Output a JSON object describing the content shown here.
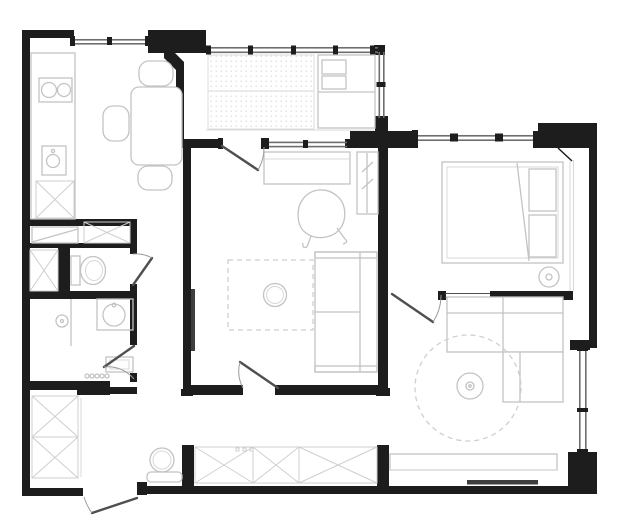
{
  "document": {
    "type": "apartment-floor-plan",
    "view": "top-down architectural drawing",
    "visible_text": "none"
  },
  "colors": {
    "background": "#ffffff",
    "wall": "#1d1d1d",
    "window": "#6e6e6e",
    "door_leaf": "#4f4f4f",
    "swing_arc": "#9a9a9a",
    "furniture": "#c3c3c3",
    "furniture_light": "#d8d8d8",
    "hatch": "#cfcfcf",
    "dark_accent": "#3f3f3f"
  },
  "rooms": [
    {
      "id": "kitchen-dining",
      "position": "top-left",
      "fixtures": [
        "kitchen-counter",
        "cooktop-two-burners",
        "kitchen-sink",
        "crosshatch-cabinet",
        "dining-table",
        "chair-top",
        "chair-left",
        "chair-bottom",
        "window-top"
      ]
    },
    {
      "id": "balcony",
      "position": "top-center",
      "fixtures": [
        "glazed-facade-with-mullions",
        "dotted-floor",
        "daybed"
      ]
    },
    {
      "id": "bedroom",
      "position": "top-right",
      "fixtures": [
        "double-bed",
        "pillows",
        "blanket-fold",
        "nightstand",
        "window-top",
        "sliding-door"
      ]
    },
    {
      "id": "living-room",
      "position": "center",
      "fixtures": [
        "desk",
        "armchair",
        "wardrobe-cabinet",
        "sofa",
        "rug",
        "pouf",
        "radiator",
        "balcony-door",
        "window-to-balcony",
        "entry-door"
      ]
    },
    {
      "id": "wc",
      "position": "middle-left",
      "fixtures": [
        "toilet",
        "crosshatch-cabinet",
        "shelf-niche",
        "door"
      ]
    },
    {
      "id": "bathroom",
      "position": "left",
      "fixtures": [
        "washbasin",
        "shower-area",
        "shower-step",
        "vent-holes",
        "door"
      ]
    },
    {
      "id": "hallway",
      "position": "bottom-left",
      "fixtures": [
        "entry-door",
        "wardrobe-crosshatch-left",
        "wardrobe-crosshatch-bottom",
        "mirror",
        "bench",
        "shoe-shelf"
      ]
    },
    {
      "id": "kids-room",
      "position": "bottom-right",
      "fixtures": [
        "corner-sofa",
        "round-rug",
        "pouf",
        "desk",
        "window-right",
        "door"
      ]
    }
  ]
}
